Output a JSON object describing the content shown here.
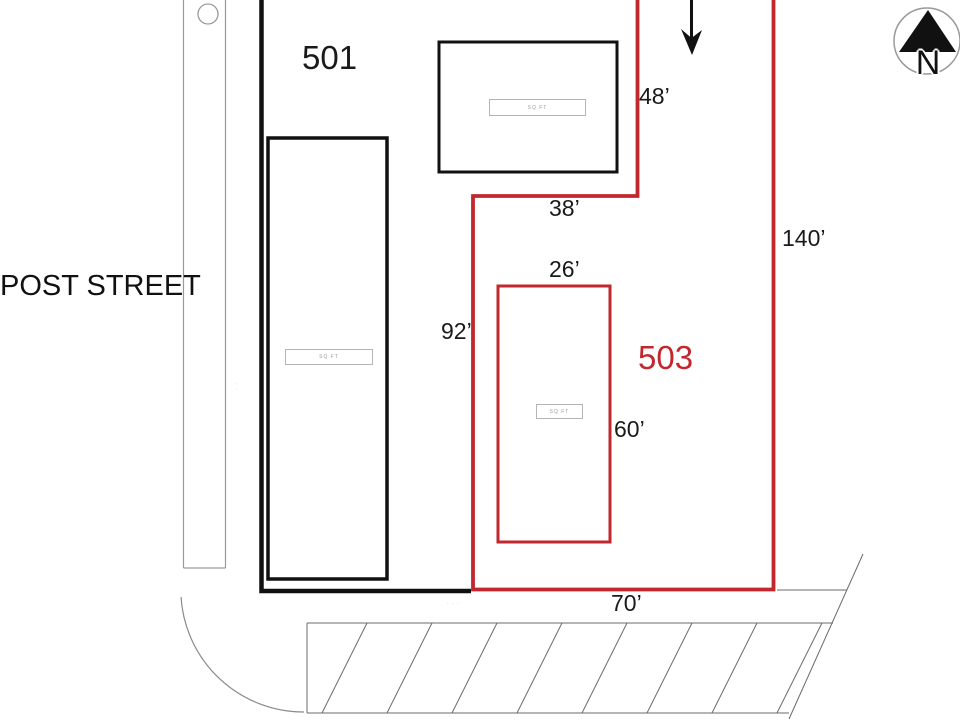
{
  "diagram": {
    "street": {
      "label": "POST STREET"
    },
    "compass": {
      "label": "N"
    },
    "lots": {
      "lot501": {
        "label": "501"
      },
      "lot503": {
        "label": "503"
      }
    },
    "dimensions": {
      "top_right_side": "48’",
      "upper_jog": "38’",
      "east_side": "140’",
      "red_building_width": "26’",
      "west_side": "92’",
      "red_building_height": "60’",
      "bottom_side": "70’"
    },
    "building_labels": {
      "top_building": "SQ FT",
      "left_building": "SQ FT",
      "red_building": "SQ FT"
    },
    "notes": {
      "bottom_note": "· · ·",
      "west_note": "· ·"
    },
    "colors": {
      "lot503_red": "#c1272d",
      "line_black": "#111111",
      "curb_gray": "#9a9a9a"
    }
  }
}
